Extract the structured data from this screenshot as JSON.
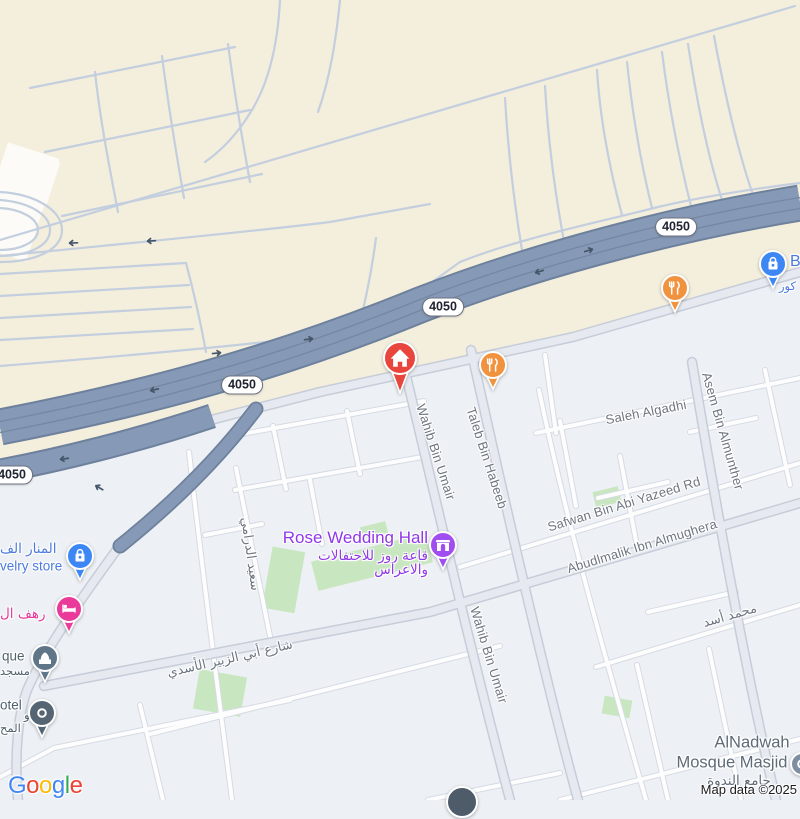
{
  "map": {
    "route_badges": [
      {
        "label": "4050",
        "x": 12,
        "y": 475
      },
      {
        "label": "4050",
        "x": 242,
        "y": 385
      },
      {
        "label": "4050",
        "x": 443,
        "y": 307
      },
      {
        "label": "4050",
        "x": 676,
        "y": 227
      }
    ],
    "labels": [
      {
        "id": "street-wahib-bin-umair-1",
        "text": "Wahib Bin Umair",
        "x": 436,
        "y": 452,
        "rot": 72,
        "cls": "street",
        "anchor": "c"
      },
      {
        "id": "street-taleb-bin-habeeb",
        "text": "Taleb Bin Habeeb",
        "x": 487,
        "y": 458,
        "rot": 72,
        "cls": "street",
        "anchor": "c"
      },
      {
        "id": "street-wahib-bin-umair-2",
        "text": "Wahib Bin Umair",
        "x": 489,
        "y": 655,
        "rot": 73,
        "cls": "street",
        "anchor": "c"
      },
      {
        "id": "street-asem-bin-almunther",
        "text": "Asem Bin Almunther",
        "x": 723,
        "y": 431,
        "rot": 74,
        "cls": "street",
        "anchor": "c"
      },
      {
        "id": "street-saleh-algadhi",
        "text": "Saleh Algadhi",
        "x": 646,
        "y": 412,
        "rot": -11,
        "cls": "street",
        "anchor": "c"
      },
      {
        "id": "street-safwan-bin-abi-yazeed",
        "text": "Safwan Bin Abi Yazeed Rd",
        "x": 624,
        "y": 504,
        "rot": -17,
        "cls": "street",
        "anchor": "c"
      },
      {
        "id": "street-abudlmalik-ibn-almughera",
        "text": "Abudlmalik Ibn Almughera",
        "x": 642,
        "y": 546,
        "rot": -17,
        "cls": "street",
        "anchor": "c"
      },
      {
        "id": "street-mohammad-asad",
        "text": "محمد أسد",
        "x": 730,
        "y": 616,
        "rot": -16,
        "cls": "street ar",
        "anchor": "c"
      },
      {
        "id": "street-saeed-aldarami",
        "text": "سعيد الدرامي",
        "x": 250,
        "y": 554,
        "rot": 82,
        "cls": "street ar",
        "anchor": "c"
      },
      {
        "id": "street-abi-alzubair-alasadi",
        "text": "شارع أبي الزبير الأسدي",
        "x": 230,
        "y": 659,
        "rot": -13,
        "cls": "street ar",
        "anchor": "c"
      },
      {
        "id": "poi-rose-wedding-hall-name",
        "text": "Rose Wedding Hall",
        "x": 428,
        "y": 538,
        "rot": 0,
        "cls": "poi-purple big",
        "anchor": "r"
      },
      {
        "id": "poi-rose-wedding-hall-ar1",
        "text": "قاعة روز للاحتفالات",
        "x": 428,
        "y": 556,
        "rot": 0,
        "cls": "poi-purple ar md",
        "anchor": "r"
      },
      {
        "id": "poi-rose-wedding-hall-ar2",
        "text": "والاعراس",
        "x": 428,
        "y": 570,
        "rot": 0,
        "cls": "poi-purple ar md",
        "anchor": "r"
      },
      {
        "id": "poi-jewelry-ar",
        "text": "المنار الف",
        "x": 0,
        "y": 549,
        "rot": 0,
        "cls": "poi-blue ar md",
        "anchor": "l"
      },
      {
        "id": "poi-jewelry-en",
        "text": "velry store",
        "x": 0,
        "y": 566,
        "rot": 0,
        "cls": "poi-blue md",
        "anchor": "l"
      },
      {
        "id": "poi-hotel-pink-ar",
        "text": "رهف ال",
        "x": 0,
        "y": 614,
        "rot": 0,
        "cls": "poi-pink ar md",
        "anchor": "l"
      },
      {
        "id": "poi-mosque-en",
        "text": "que",
        "x": 2,
        "y": 656,
        "rot": 0,
        "cls": "poi-slate md",
        "anchor": "l"
      },
      {
        "id": "poi-mosque-ar",
        "text": "مسجد",
        "x": 0,
        "y": 671,
        "rot": 0,
        "cls": "poi-slate ar sm",
        "anchor": "l"
      },
      {
        "id": "poi-hotel2-en",
        "text": "otel",
        "x": 0,
        "y": 705,
        "rot": 0,
        "cls": "poi-slate md",
        "anchor": "l"
      },
      {
        "id": "poi-hotel2-ar1",
        "text": "شقو",
        "x": 24,
        "y": 715,
        "rot": 0,
        "cls": "poi-slate ar sm",
        "anchor": "l"
      },
      {
        "id": "poi-hotel2-ar2",
        "text": "المح",
        "x": 0,
        "y": 728,
        "rot": 0,
        "cls": "poi-slate ar sm",
        "anchor": "l"
      },
      {
        "id": "poi-shop-partial-en",
        "text": "B",
        "x": 790,
        "y": 262,
        "rot": 0,
        "cls": "poi-blue b16",
        "anchor": "l"
      },
      {
        "id": "poi-shop-partial-ar",
        "text": "كور",
        "x": 779,
        "y": 286,
        "rot": 0,
        "cls": "poi-blue ar sm",
        "anchor": "l"
      },
      {
        "id": "poi-alnadwah-line1",
        "text": "AlNadwah",
        "x": 752,
        "y": 743,
        "rot": 0,
        "cls": "locality",
        "anchor": "c"
      },
      {
        "id": "poi-alnadwah-line2",
        "text": "Mosque Masjid (",
        "x": 737,
        "y": 763,
        "rot": 0,
        "cls": "locality",
        "anchor": "c"
      },
      {
        "id": "poi-alnadwah-ar",
        "text": "جامع الندوة",
        "x": 739,
        "y": 781,
        "rot": 0,
        "cls": "locality ar md",
        "anchor": "c"
      }
    ],
    "pois": [
      {
        "id": "home-marker",
        "type": "house",
        "color": "#e8453c",
        "x": 400,
        "y": 358,
        "r": 16
      },
      {
        "id": "restaurant-marker-1",
        "type": "fork",
        "color": "#f0923e",
        "x": 493,
        "y": 365,
        "r": 13
      },
      {
        "id": "restaurant-marker-2",
        "type": "fork",
        "color": "#f0923e",
        "x": 675,
        "y": 288,
        "r": 13
      },
      {
        "id": "shopping-marker",
        "type": "bag",
        "color": "#3d87f5",
        "x": 773,
        "y": 264,
        "r": 13
      },
      {
        "id": "jewelry-store-marker",
        "type": "bag",
        "color": "#3d87f5",
        "x": 80,
        "y": 556,
        "r": 13
      },
      {
        "id": "hotel-pink-marker",
        "type": "bed",
        "color": "#ea3b9a",
        "x": 69,
        "y": 609,
        "r": 13
      },
      {
        "id": "mosque-marker",
        "type": "mosque",
        "color": "#5f7689",
        "x": 45,
        "y": 658,
        "r": 13
      },
      {
        "id": "hotel-gray-marker",
        "type": "ring",
        "color": "#566573",
        "x": 42,
        "y": 713,
        "r": 13
      },
      {
        "id": "wedding-hall-marker",
        "type": "hall",
        "color": "#a14ef0",
        "x": 443,
        "y": 545,
        "r": 13
      },
      {
        "id": "alnadwah-partial-marker",
        "type": "ring",
        "color": "#7d8fa0",
        "x": 802,
        "y": 764,
        "r": 11,
        "notail": true
      },
      {
        "id": "bottom-partial-marker",
        "type": "none",
        "color": "#4e5b68",
        "x": 462,
        "y": 802,
        "r": 15,
        "notail": true
      }
    ],
    "arrows": [
      {
        "x": 218,
        "y": 353,
        "rot": -6
      },
      {
        "x": 150,
        "y": 241,
        "rot": 177
      },
      {
        "x": 72,
        "y": 243,
        "rot": 178
      },
      {
        "x": 63,
        "y": 459,
        "rot": 172
      },
      {
        "x": 310,
        "y": 339,
        "rot": -8
      },
      {
        "x": 538,
        "y": 272,
        "rot": 163
      },
      {
        "x": 590,
        "y": 250,
        "rot": -17
      },
      {
        "x": 98,
        "y": 487,
        "rot": 210
      },
      {
        "x": 153,
        "y": 390,
        "rot": 168
      }
    ],
    "logo": {
      "letters": [
        {
          "ch": "G",
          "color": "#4285F4"
        },
        {
          "ch": "o",
          "color": "#EA4335"
        },
        {
          "ch": "o",
          "color": "#FBBC05"
        },
        {
          "ch": "g",
          "color": "#4285F4"
        },
        {
          "ch": "l",
          "color": "#34A853"
        },
        {
          "ch": "e",
          "color": "#EA4335"
        }
      ]
    },
    "attribution": "Map data ©2025",
    "colors": {
      "beige_area": "#f4eedd",
      "urban_area": "#edf0f4",
      "highway_fill": "#8699b6",
      "highway_casing": "#6d809c",
      "lane_line": "#7487a3",
      "thin_road": "#c3cede",
      "road_minor_fill": "#fdfdfe",
      "road_minor_casing": "#d6dbe3",
      "road_major_fill": "#e6eaf0",
      "road_major_casing": "#c6cdd9",
      "park_green": "#c8e7c0",
      "street_label": "#6d7581",
      "purple_poi": "#9037ea",
      "blue_poi": "#4b79dd",
      "pink_poi": "#e8389b",
      "slate_poi": "#50626f",
      "red_pin": "#e8453c",
      "orange_pin": "#f0923e"
    }
  }
}
